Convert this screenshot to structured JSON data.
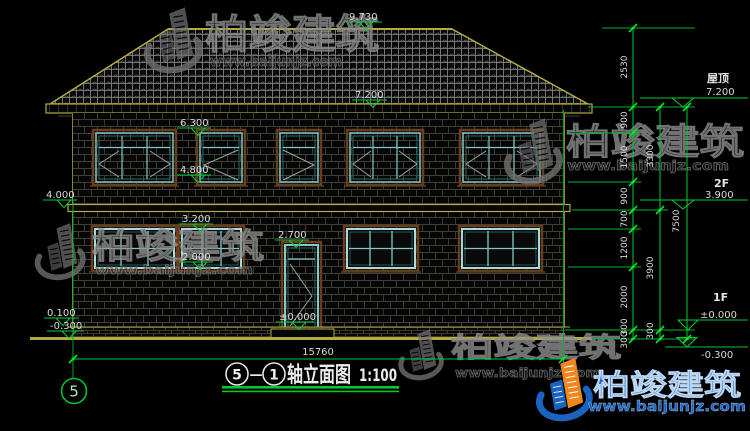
{
  "drawing": {
    "axis_bubble": "5",
    "title": {
      "axis_a": "5",
      "axis_b": "1",
      "dash": "—",
      "name": "轴立面图",
      "scale": "1:100"
    },
    "overall_width": "15760",
    "floors": {
      "roof": "屋顶",
      "second": "2F",
      "first": "1F"
    },
    "levels": {
      "ridge": "9.730",
      "eave": "7.200",
      "roof_right": "7.200",
      "w2_top": "6.300",
      "w2_sill": "4.800",
      "belt": "4.000",
      "f2": "3.900",
      "w1_top": "3.200",
      "door_top": "2.700",
      "w1_sill": "2.000",
      "zero_door": "±0.000",
      "zero_right": "±0.000",
      "plinth": "0.100",
      "ground_left": "-0.300",
      "ground_right": "-0.300"
    },
    "chain1": [
      "2530",
      "900",
      "1500",
      "900",
      "700",
      "1200",
      "2000",
      "300",
      "300"
    ],
    "chain2": [
      "3300",
      "3900",
      "300"
    ],
    "chain3": [
      "7500"
    ]
  },
  "watermark": {
    "brand": "柏竣建筑",
    "url": "www.baijunjz.com"
  },
  "colors": {
    "cad_yellow": "#b3ab3f",
    "dim_green": "#00c832",
    "window_teal": "#7fc9c9",
    "brand_blue": "#1a63c0",
    "brand_orange": "#f0861c"
  }
}
